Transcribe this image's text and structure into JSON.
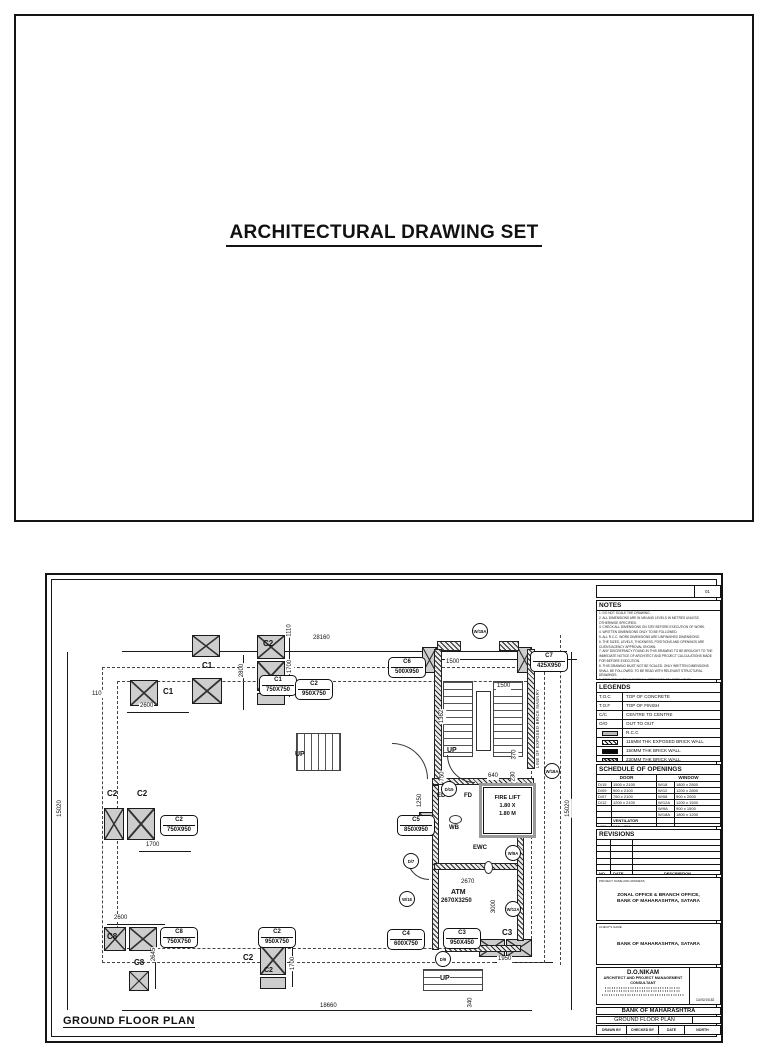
{
  "page1": {
    "title": "ARCHITECTURAL DRAWING SET"
  },
  "sheet": {
    "sheet_no": "01",
    "notes": {
      "title": "NOTES",
      "lines": [
        "1. DO NOT SCALE THE DRAWING.",
        "2. ALL DIMENSIONS ARE IN MM AND LEVELS IN METRES UNLESS OTHERWISE SPECIFIED.",
        "3. CHECK ALL DIMENSIONS ON SITE BEFORE EXECUTION OF WORK.",
        "4. WRITTEN DIMENSIONS ONLY TO BE FOLLOWED.",
        "5. ALL R.C.C. WORK DIMENSIONS ARE UNFINISHED DIMENSIONS.",
        "6. THE SIZES, LEVELS, THICKNESS, POSITIONS AND OPENINGS ARE CLIENT/AGENCY APPROVAL SHOWN.",
        "7. ANY DISCREPANCY FOUND IN THIS DRAWING TO BE BROUGHT TO THE IMMEDIATE NOTICE OF ARCHITECT AND PROJECT CALCULATIONS MADE FOR BEFORE EXECUTION.",
        "8. THIS DRAWING MUST NOT BE SCALED. ONLY WRITTEN DIMENSIONS SHALL BE FOLLOWED. TO BE READ WITH RELEVANT STRUCTURAL DRAWINGS.",
        "9. PROVIDE LINTELS OVER ALL OPENINGS AT LINTEL LEVEL.",
        "10. THE STRUCTURAL CONSULTANT SHALL BE RESPONSIBLE FOR THE STRUCTURAL DESIGN.",
        "11. ARCHITECT SHALL NOT BE RESPONSIBLE IN ANY MANNER FOR THE GENERAL STRUCTURAL AND ELECTRICAL WORKS ON SITE FOR R.C.C. PURPOSE.",
        "12. ALL DOOR/WINDOW FRAMES SHALL BE FIXED AS PER SCHEDULE. EXPERT LEVEL G.S.IT OUT IN SLAB BEFORE BRICK WORK STARTS ON GROUND."
      ]
    },
    "legends": {
      "title": "LEGENDS",
      "rows": [
        {
          "key": "T.O.C",
          "value": "TOP OF CONCRETE"
        },
        {
          "key": "T.O.F",
          "value": "TOP OF FINISH"
        },
        {
          "key": "C/C",
          "value": "CENTRE TO CENTRE"
        },
        {
          "key": "O/O",
          "value": "OUT TO OUT"
        },
        {
          "key": "",
          "value": "R.C.C"
        },
        {
          "key": "",
          "value": "115MM THK EXPOSED BRICK WALL"
        },
        {
          "key": "",
          "value": "150MM THK BRICK WALL"
        },
        {
          "key": "",
          "value": "230MM THK BRICK WALL"
        }
      ]
    },
    "schedule": {
      "title": "SCHEDULE OF OPENINGS",
      "door": "DOOR",
      "window": "WINDOW",
      "rows": [
        [
          "D/15",
          "1500 x 2100",
          "W/18",
          "1800 x 2800"
        ],
        [
          "D/09",
          "900 x 2100",
          "W/12",
          "1200 x 2800"
        ],
        [
          "D/07",
          "750 x 2100",
          "W/08",
          "900 x 2000"
        ],
        [
          "D/12",
          "1200 x 2100",
          "W/12A",
          "1200 x 1500"
        ],
        [
          "",
          "",
          "W/9A",
          "900 x 1500"
        ],
        [
          "",
          "",
          "W/18A",
          "1800 x 1200"
        ],
        [
          "",
          "VENTILATOR",
          "",
          ""
        ],
        [
          "V/06",
          "600 x 750",
          "",
          ""
        ]
      ]
    },
    "revisions": {
      "title": "REVISIONS",
      "no": "NO",
      "date": "DATE",
      "description": "DESCRIPTION"
    },
    "project": {
      "caption": "PROJECT NAME AND ADDRESS",
      "text": "ZONAL OFFICE & BRANCH OFFICE,\nBANK OF MAHARASHTRA, SATARA"
    },
    "client": {
      "caption": "CLIENT'S NAME",
      "text": "BANK OF MAHARASHTRA, SATARA"
    },
    "architect": {
      "name": "D.O.NIKAM",
      "role": "ARCHITECT AND PROJECT MANAGEMENT\nCONSULTANT",
      "reg": "CA/92/15182"
    },
    "titleblock": {
      "bank": "BANK OF MAHARASHTRA",
      "drawing": "GROUND FLOOR PLAN",
      "drawn": "DRAWN BY",
      "checked": "CHECKED BY",
      "date": "DATE",
      "north": "NORTH"
    }
  },
  "plan": {
    "title": "GROUND FLOOR PLAN",
    "masonry_note": "LINE OF EXPOSED BRICK MASNRY",
    "tags": [
      {
        "name": "C1",
        "size": "750X750"
      },
      {
        "name": "C2",
        "size": "950X750"
      },
      {
        "name": "C6",
        "size": "500X950"
      },
      {
        "name": "C7",
        "size": "425X950"
      },
      {
        "name": "C2",
        "size": "750X950"
      },
      {
        "name": "C5",
        "size": "850X950"
      },
      {
        "name": "C8",
        "size": "750X750"
      },
      {
        "name": "C2",
        "size": "950X750"
      },
      {
        "name": "C4",
        "size": "600X750"
      },
      {
        "name": "C3",
        "size": "950X450"
      }
    ],
    "dims": [
      "28160",
      "15020",
      "15020",
      "18660",
      "110",
      "2600",
      "2800",
      "1110",
      "1700",
      "1700",
      "2600",
      "2645",
      "1700",
      "1500",
      "1500",
      "1362",
      "370",
      "750",
      "1250",
      "640",
      "230",
      "2670",
      "3000",
      "1950",
      "340"
    ],
    "circles": [
      "W/18A",
      "W/18A",
      "W/9A",
      "W/12A",
      "D/15",
      "D/7",
      "W/18",
      "D/9"
    ],
    "labels": {
      "up": "UP",
      "ed": "ED",
      "fd": "FD",
      "wb": "WB",
      "ewc": "EWC",
      "atm": "ATM",
      "atm_size": "2670X3250",
      "fire1": "FIRE LIFT",
      "fire2": "1.80 X",
      "fire3": "1.80 M",
      "c1a": "C1",
      "c1b": "C1",
      "c2a": "C2",
      "c2b": "C2",
      "c2c": "C2",
      "c8a": "C8",
      "c8b": "C8",
      "c2d": "C2",
      "c2e": "C2",
      "c3": "C3"
    }
  }
}
